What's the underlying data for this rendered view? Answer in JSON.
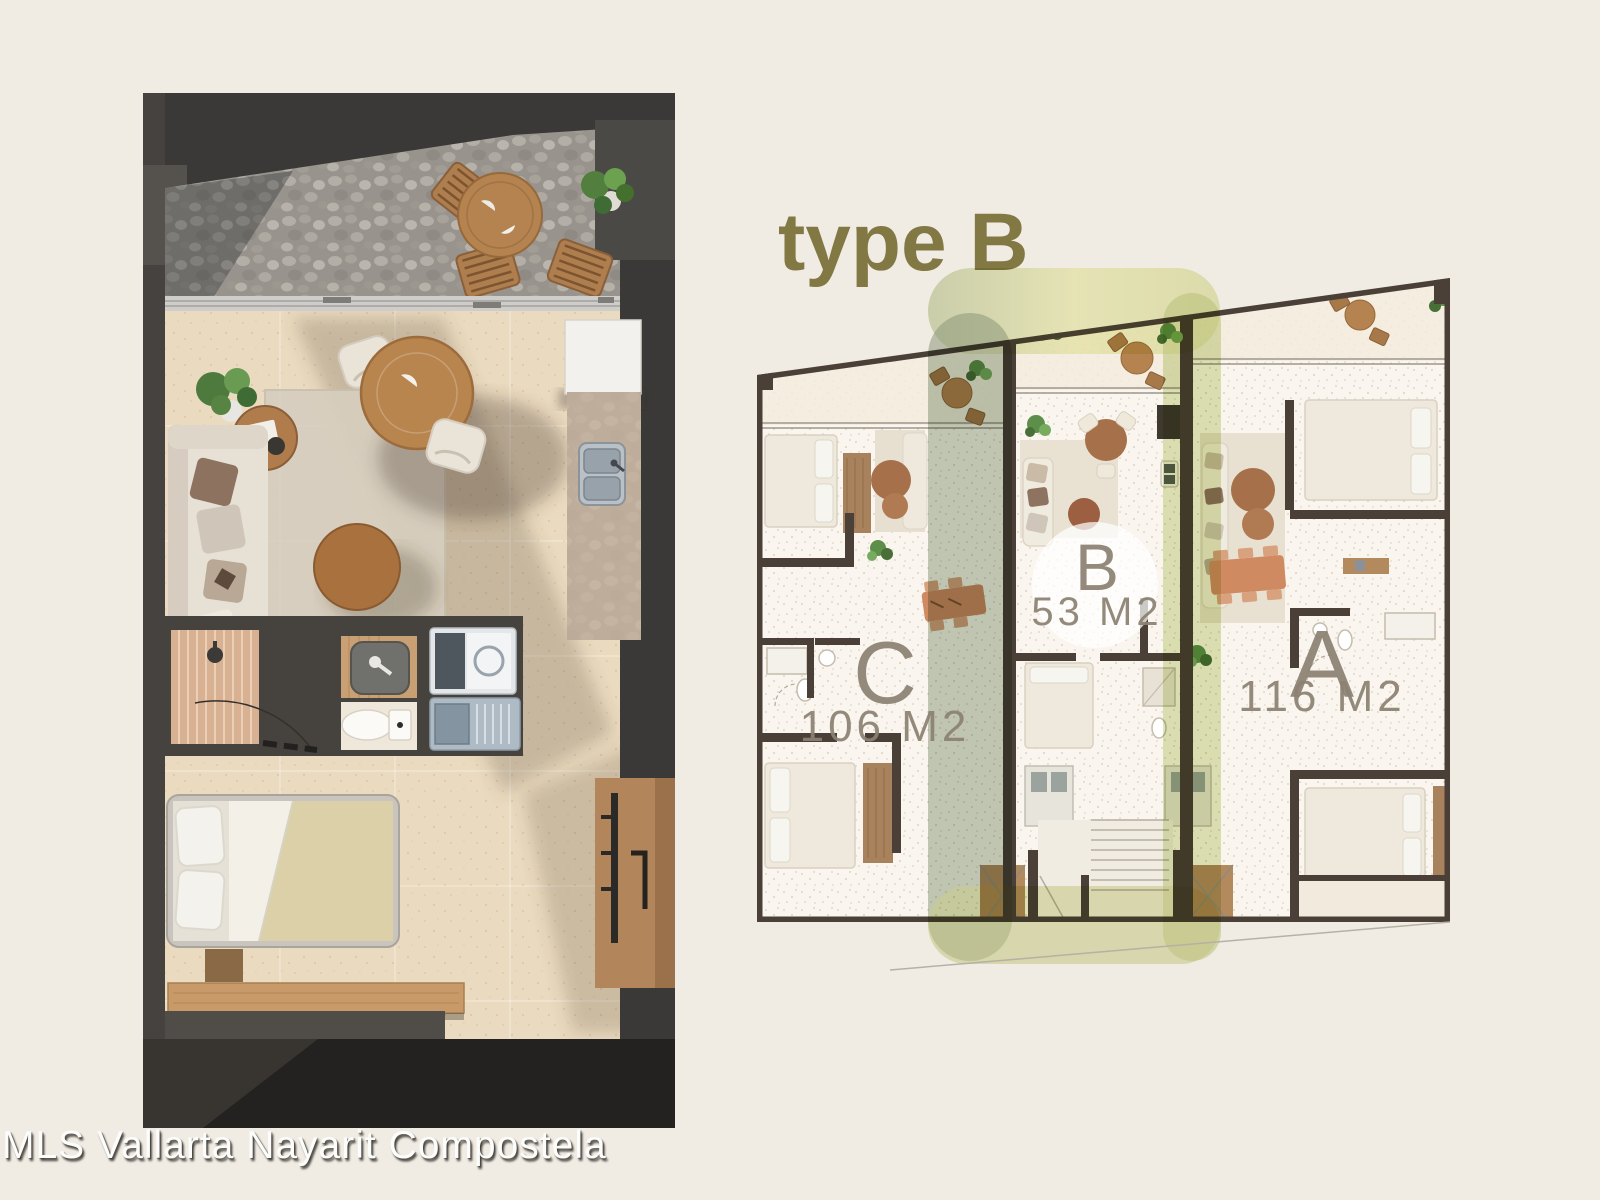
{
  "page": {
    "background_color": "#f1ece3"
  },
  "title": {
    "text": "type B",
    "color": "#827844"
  },
  "watermark": {
    "text": "MLS Vallarta Nayarit Compostela",
    "color": "#fdfdfc"
  },
  "apartment_render": {
    "description": "3D top-down render of the type B apartment",
    "wall_color": "#3b3937",
    "floor_color": "#eadabf",
    "terrace_pebble_color": "#98948d",
    "rooms": [
      "terrace",
      "living-dining",
      "kitchen",
      "bathroom",
      "laundry",
      "bedroom"
    ]
  },
  "floorplate": {
    "wall_color": "#4a4037",
    "floor_color": "#faf6ef",
    "label_color": "#8b8071",
    "highlight_color": "#cdd592",
    "units": [
      {
        "letter": "C",
        "area": "106 M2",
        "highlighted": false
      },
      {
        "letter": "B",
        "area": "53 M2",
        "highlighted": true
      },
      {
        "letter": "A",
        "area": "116 M2",
        "highlighted": false
      }
    ]
  }
}
